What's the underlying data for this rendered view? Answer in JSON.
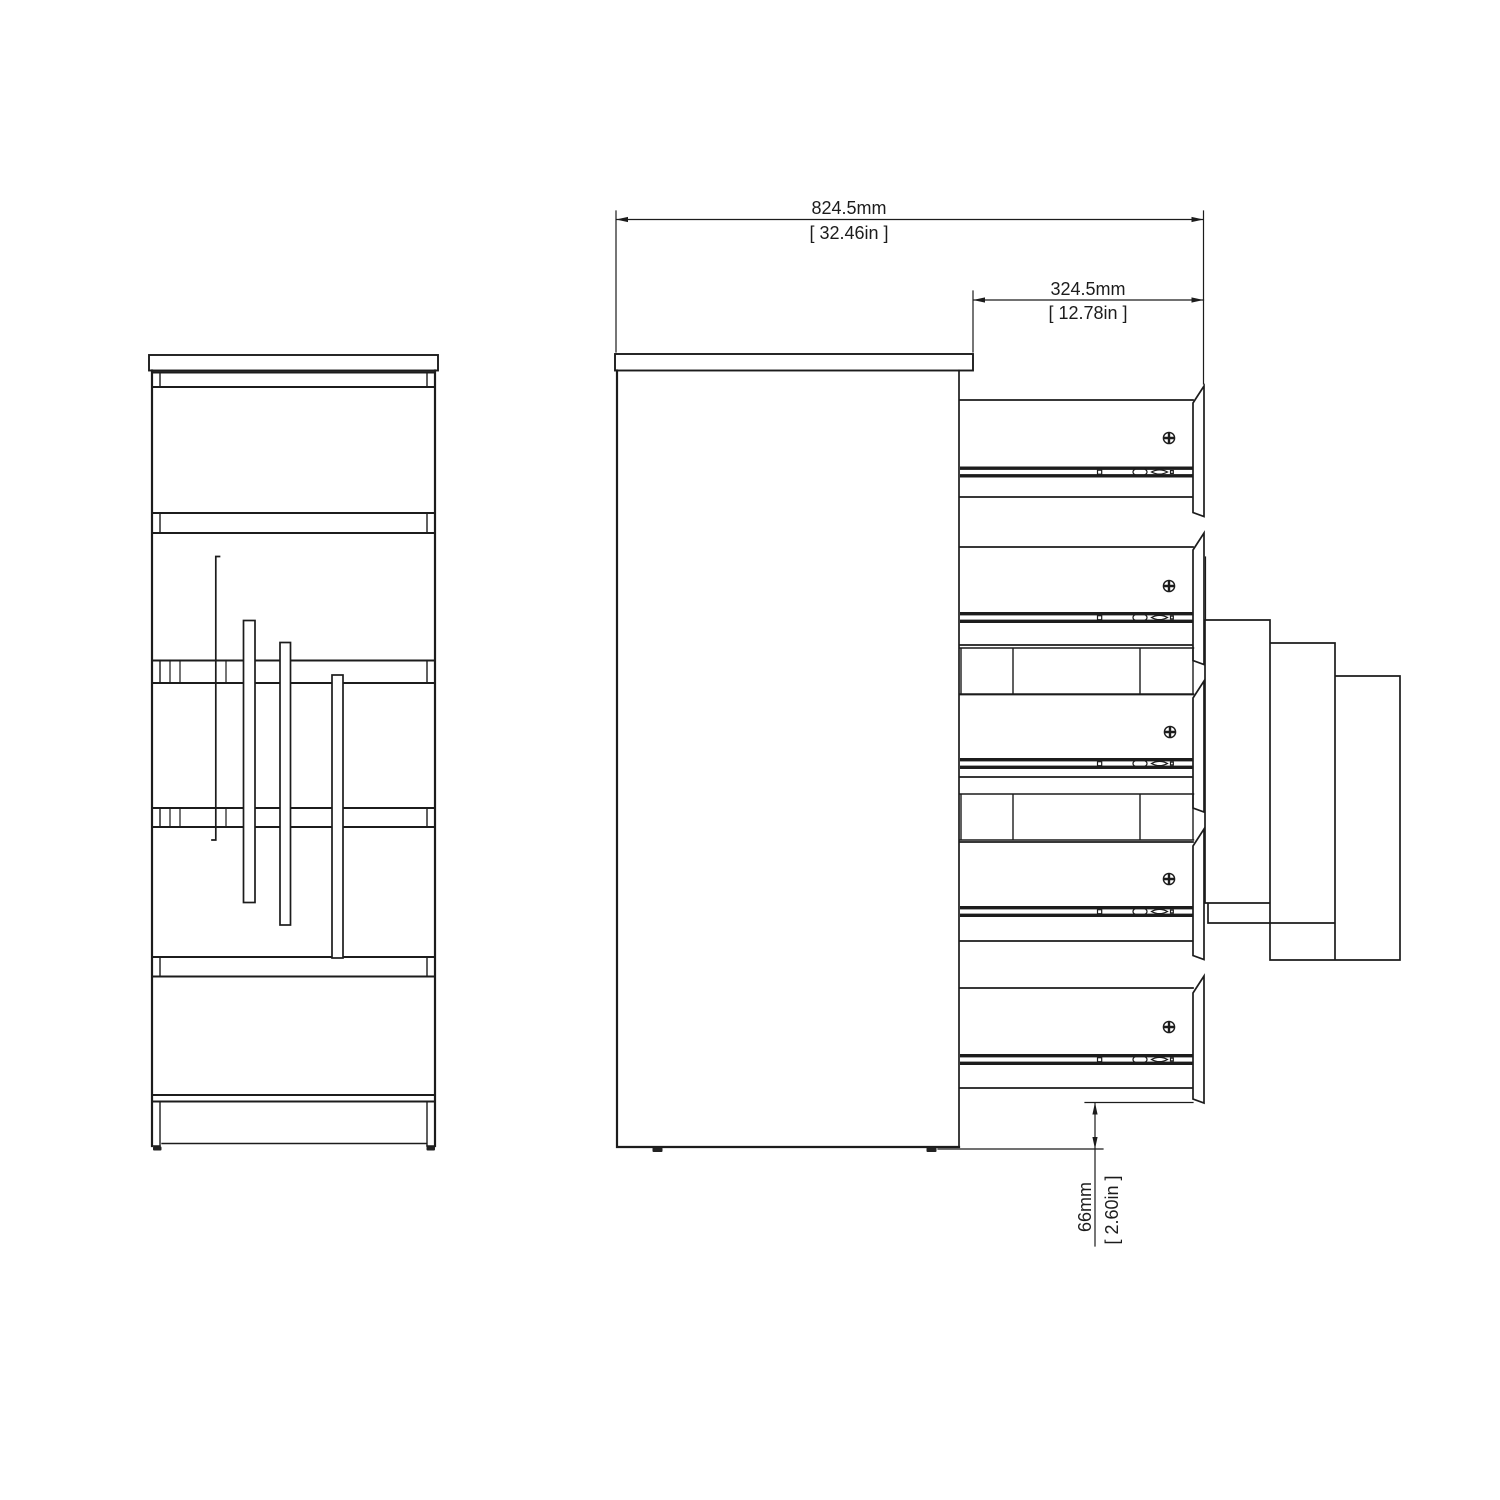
{
  "drawing": {
    "background_color": "#ffffff",
    "line_color": "#1c1c1c",
    "drawer_count": 5,
    "icons": {
      "screw": "phillips-screw-head-icon",
      "rail": "drawer-slide-rail"
    },
    "dimensions": {
      "overall_depth": {
        "metric": "824.5mm",
        "imperial": "[ 32.46in ]"
      },
      "drawer_extension": {
        "metric": "324.5mm",
        "imperial": "[ 12.78in ]"
      },
      "base_clearance": {
        "metric": "66mm",
        "imperial": "[ 2.60in ]"
      }
    }
  }
}
